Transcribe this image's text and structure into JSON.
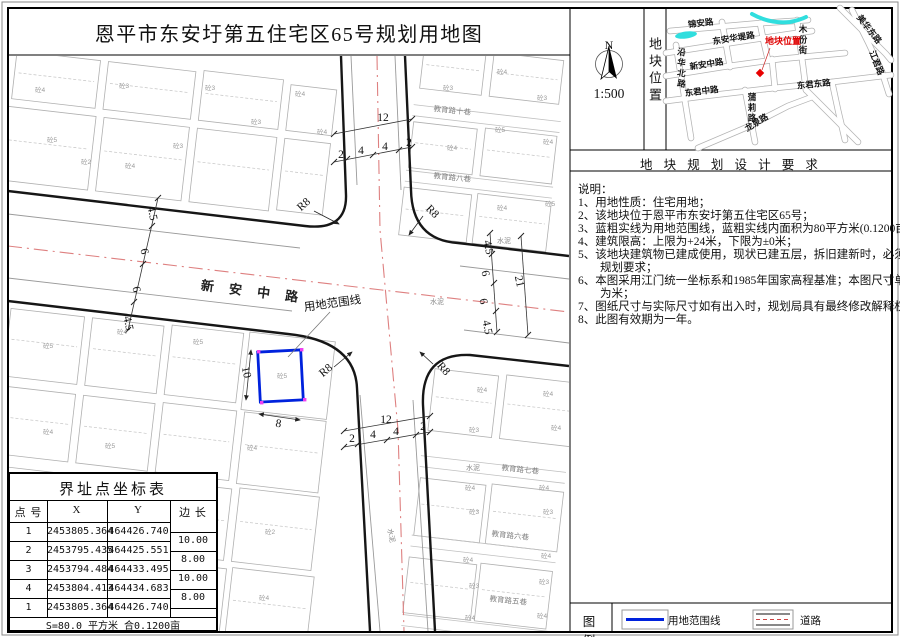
{
  "title": "恩平市东安圩第五住宅区65号规划用地图",
  "compass": {
    "north": "N",
    "scale": "1:500"
  },
  "location_panel": {
    "side_label": "地块位置",
    "labels": [
      {
        "t": "锦安路",
        "x": 701,
        "y": 26,
        "r": -7,
        "c": "mm"
      },
      {
        "t": "东安华堤路",
        "x": 734,
        "y": 41,
        "r": -9,
        "c": "mm"
      },
      {
        "t": "新安中路",
        "x": 707,
        "y": 67,
        "r": -9,
        "c": "mm"
      },
      {
        "t": "东君中路",
        "x": 702,
        "y": 94,
        "r": -7,
        "c": "mm"
      },
      {
        "t": "东君东路",
        "x": 814,
        "y": 87,
        "r": -6,
        "c": "mm"
      },
      {
        "t": "龙泉路",
        "x": 758,
        "y": 125,
        "r": -32,
        "c": "mm"
      },
      {
        "t": "美华东路",
        "x": 867,
        "y": 31,
        "r": 52,
        "c": "mm"
      },
      {
        "t": "江君路",
        "x": 874,
        "y": 64,
        "r": 68,
        "c": "mm"
      },
      {
        "t": "木份街",
        "x": 803,
        "y": 32,
        "v": 1,
        "c": "mm"
      },
      {
        "t": "蒲莉路",
        "x": 752,
        "y": 100,
        "v": 1,
        "c": "mm"
      },
      {
        "t": "沿华北路",
        "x": 681,
        "y": 55,
        "v": 1,
        "r": 10,
        "c": "mm"
      },
      {
        "t": "地块位置",
        "x": 783,
        "y": 44,
        "c": "red"
      }
    ]
  },
  "requirements": {
    "header": "地 块 规 划 设 计 要 求",
    "lines": [
      {
        "t": "说明："
      },
      {
        "t": "1、用地性质：住宅用地；"
      },
      {
        "t": "2、该地块位于恩平市东安圩第五住宅区65号；"
      },
      {
        "t": "3、蓝粗实线为用地范围线，蓝粗实线内面积为80平方米(0.1200亩)；"
      },
      {
        "t": "4、建筑限高：上限为+24米，下限为±0米；"
      },
      {
        "t": "5、该地块建筑物已建成使用，现状已建五层，拆旧建新时，必须符合"
      },
      {
        "t": "规划要求；",
        "cont": true
      },
      {
        "t": "6、本图采用江门统一坐标系和1985年国家高程基准；本图尺寸单位"
      },
      {
        "t": "为米；",
        "cont": true
      },
      {
        "t": "7、图纸尺寸与实际尺寸如有出入时，规划局具有最终修改解释权；"
      },
      {
        "t": "8、此图有效期为一年。"
      }
    ]
  },
  "legend": {
    "title": "图 例",
    "items": [
      {
        "label": "用地范围线",
        "type": "boundary",
        "color": "#0022dd"
      },
      {
        "label": "道路",
        "type": "road",
        "color": "#cc4444"
      }
    ]
  },
  "coord_table": {
    "title": "界址点坐标表",
    "headers": [
      "点 号",
      "X",
      "Y",
      "边 长"
    ],
    "rows": [
      [
        "1",
        "2453805.364",
        "464426.740"
      ],
      [
        "2",
        "2453795.435",
        "464425.551"
      ],
      [
        "3",
        "2453794.484",
        "464433.495"
      ],
      [
        "4",
        "2453804.413",
        "464434.683"
      ],
      [
        "1",
        "2453805.364",
        "464426.740"
      ]
    ],
    "edge_lengths": [
      "10.00",
      "8.00",
      "10.00",
      "8.00"
    ],
    "footer": "S=80.0 平方米 合0.1200亩"
  },
  "map": {
    "labels": [
      {
        "t": "新 安 中 路",
        "x": 252,
        "y": 296,
        "r": 7,
        "c": "roadname"
      },
      {
        "t": "用地范围线",
        "x": 333,
        "y": 307,
        "r": -8,
        "c": "dim"
      },
      {
        "t": "12",
        "x": 383,
        "y": 121,
        "c": "dim"
      },
      {
        "t": "2",
        "x": 341,
        "y": 158,
        "c": "dim"
      },
      {
        "t": "4",
        "x": 361,
        "y": 154,
        "c": "dim"
      },
      {
        "t": "4",
        "x": 385,
        "y": 150,
        "c": "dim"
      },
      {
        "t": "2",
        "x": 409,
        "y": 146,
        "c": "dim"
      },
      {
        "t": "12",
        "x": 386,
        "y": 423,
        "c": "dim"
      },
      {
        "t": "2",
        "x": 352,
        "y": 442,
        "c": "dim"
      },
      {
        "t": "4",
        "x": 373,
        "y": 438,
        "c": "dim"
      },
      {
        "t": "4",
        "x": 396,
        "y": 435,
        "c": "dim"
      },
      {
        "t": "2",
        "x": 423,
        "y": 430,
        "c": "dim"
      },
      {
        "t": "4.5",
        "x": 149,
        "y": 214,
        "r": 78,
        "c": "dim"
      },
      {
        "t": "6",
        "x": 141,
        "y": 252,
        "r": 78,
        "c": "dim"
      },
      {
        "t": "6",
        "x": 133,
        "y": 290,
        "r": 78,
        "c": "dim"
      },
      {
        "t": "4.5",
        "x": 125,
        "y": 324,
        "r": 78,
        "c": "dim"
      },
      {
        "t": "4.5",
        "x": 485,
        "y": 248,
        "r": 78,
        "c": "dim"
      },
      {
        "t": "6",
        "x": 482,
        "y": 274,
        "r": 78,
        "c": "dim"
      },
      {
        "t": "6",
        "x": 480,
        "y": 302,
        "r": 78,
        "c": "dim"
      },
      {
        "t": "4.5",
        "x": 484,
        "y": 328,
        "r": 78,
        "c": "dim"
      },
      {
        "t": "21",
        "x": 516,
        "y": 282,
        "r": 78,
        "c": "dim"
      },
      {
        "t": "10",
        "x": 243,
        "y": 373,
        "r": 78,
        "c": "dim"
      },
      {
        "t": "8",
        "x": 278,
        "y": 427,
        "r": 8,
        "c": "dim"
      },
      {
        "t": "R8",
        "x": 306,
        "y": 207,
        "r": -42,
        "c": "dim"
      },
      {
        "t": "R8",
        "x": 430,
        "y": 214,
        "r": 45,
        "c": "dim"
      },
      {
        "t": "R8",
        "x": 328,
        "y": 373,
        "r": -40,
        "c": "dim"
      },
      {
        "t": "R8",
        "x": 441,
        "y": 371,
        "r": 48,
        "c": "dim"
      },
      {
        "t": "教育路十巷",
        "x": 452,
        "y": 113,
        "r": 6,
        "c": "lane"
      },
      {
        "t": "教育路八巷",
        "x": 452,
        "y": 180,
        "r": 6,
        "c": "lane"
      },
      {
        "t": "教育路七巷",
        "x": 520,
        "y": 472,
        "r": 6,
        "c": "lane"
      },
      {
        "t": "教育路六巷",
        "x": 510,
        "y": 538,
        "r": 6,
        "c": "lane"
      },
      {
        "t": "教育路五巷",
        "x": 508,
        "y": 603,
        "r": 6,
        "c": "lane"
      },
      {
        "t": "水泥",
        "x": 437,
        "y": 304,
        "c": "cement"
      },
      {
        "t": "水泥",
        "x": 504,
        "y": 243,
        "c": "cement"
      },
      {
        "t": "水泥",
        "x": 389,
        "y": 536,
        "r": 78,
        "c": "cement"
      },
      {
        "t": "水泥",
        "x": 473,
        "y": 470,
        "c": "cement"
      },
      {
        "t": "砼4",
        "x": 40,
        "y": 92,
        "c": "bl"
      },
      {
        "t": "砼3",
        "x": 124,
        "y": 88,
        "c": "bl"
      },
      {
        "t": "砼3",
        "x": 210,
        "y": 90,
        "c": "bl"
      },
      {
        "t": "砼4",
        "x": 300,
        "y": 96,
        "c": "bl"
      },
      {
        "t": "砼5",
        "x": 52,
        "y": 142,
        "c": "bl"
      },
      {
        "t": "砼2",
        "x": 86,
        "y": 164,
        "c": "bl"
      },
      {
        "t": "砼4",
        "x": 130,
        "y": 168,
        "c": "bl"
      },
      {
        "t": "砼3",
        "x": 178,
        "y": 148,
        "c": "bl"
      },
      {
        "t": "砼3",
        "x": 256,
        "y": 124,
        "c": "bl"
      },
      {
        "t": "砼4",
        "x": 322,
        "y": 134,
        "c": "bl"
      },
      {
        "t": "砼3",
        "x": 448,
        "y": 90,
        "c": "bl"
      },
      {
        "t": "砼4",
        "x": 502,
        "y": 74,
        "c": "bl"
      },
      {
        "t": "砼3",
        "x": 542,
        "y": 100,
        "c": "bl"
      },
      {
        "t": "砼4",
        "x": 452,
        "y": 150,
        "c": "bl"
      },
      {
        "t": "砼5",
        "x": 500,
        "y": 132,
        "c": "bl"
      },
      {
        "t": "砼4",
        "x": 548,
        "y": 144,
        "c": "bl"
      },
      {
        "t": "砼4",
        "x": 502,
        "y": 210,
        "c": "bl"
      },
      {
        "t": "砼5",
        "x": 550,
        "y": 206,
        "c": "bl"
      },
      {
        "t": "砼5",
        "x": 48,
        "y": 348,
        "c": "bl"
      },
      {
        "t": "砼4",
        "x": 122,
        "y": 334,
        "c": "bl"
      },
      {
        "t": "砼5",
        "x": 198,
        "y": 344,
        "c": "bl"
      },
      {
        "t": "砼5",
        "x": 282,
        "y": 378,
        "c": "bl"
      },
      {
        "t": "砼4",
        "x": 48,
        "y": 434,
        "c": "bl"
      },
      {
        "t": "砼5",
        "x": 110,
        "y": 448,
        "c": "bl"
      },
      {
        "t": "砼4",
        "x": 252,
        "y": 450,
        "c": "bl"
      },
      {
        "t": "砼2",
        "x": 202,
        "y": 526,
        "c": "bl"
      },
      {
        "t": "砼2",
        "x": 270,
        "y": 534,
        "c": "bl"
      },
      {
        "t": "砼4",
        "x": 264,
        "y": 600,
        "c": "bl"
      },
      {
        "t": "砼4",
        "x": 482,
        "y": 392,
        "c": "bl"
      },
      {
        "t": "砼4",
        "x": 548,
        "y": 396,
        "c": "bl"
      },
      {
        "t": "砼3",
        "x": 474,
        "y": 432,
        "c": "bl"
      },
      {
        "t": "砼4",
        "x": 556,
        "y": 430,
        "c": "bl"
      },
      {
        "t": "砼4",
        "x": 470,
        "y": 490,
        "c": "bl"
      },
      {
        "t": "砼4",
        "x": 544,
        "y": 490,
        "c": "bl"
      },
      {
        "t": "砼3",
        "x": 474,
        "y": 514,
        "c": "bl"
      },
      {
        "t": "砼3",
        "x": 548,
        "y": 514,
        "c": "bl"
      },
      {
        "t": "砼4",
        "x": 468,
        "y": 562,
        "c": "bl"
      },
      {
        "t": "砼4",
        "x": 546,
        "y": 558,
        "c": "bl"
      },
      {
        "t": "砼3",
        "x": 474,
        "y": 588,
        "c": "bl"
      },
      {
        "t": "砼3",
        "x": 544,
        "y": 584,
        "c": "bl"
      },
      {
        "t": "砼4",
        "x": 470,
        "y": 620,
        "c": "bl"
      },
      {
        "t": "砼4",
        "x": 542,
        "y": 618,
        "c": "bl"
      }
    ]
  }
}
